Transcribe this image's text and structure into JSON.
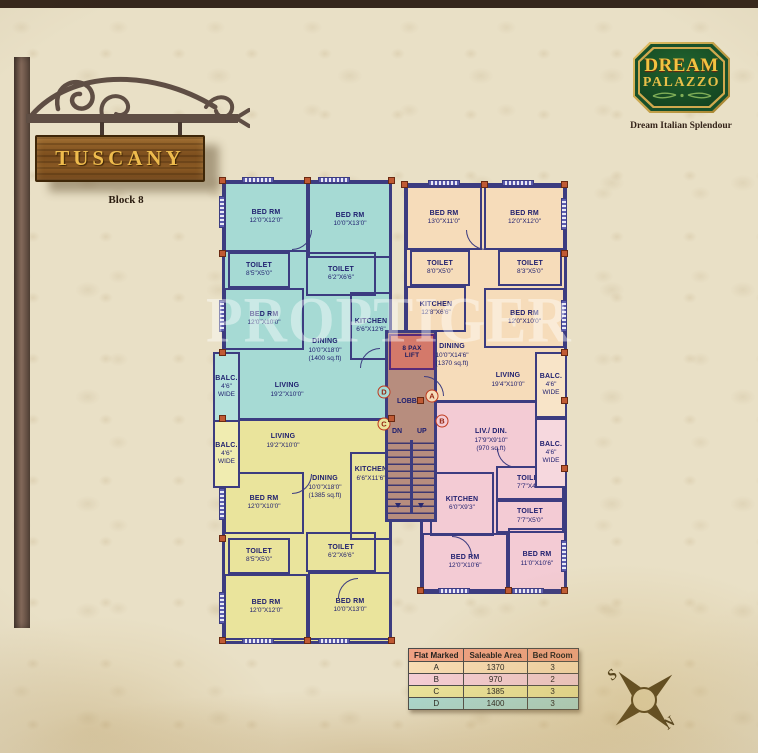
{
  "sign": {
    "title": "TUSCANY",
    "block_label": "Block 8"
  },
  "logo": {
    "name_line1": "DREAM",
    "name_line2": "PALAZZO",
    "tagline": "Dream Italian Splendour"
  },
  "watermark": "PROPTIGER",
  "compass": {
    "south": "S",
    "north": "N"
  },
  "core": {
    "lift_line1": "8 PAX",
    "lift_line2": "LIFT",
    "lobby": "LOBBY",
    "down": "DN",
    "up": "UP"
  },
  "flats": {
    "d": {
      "marker": "D",
      "color": "#a6dad4",
      "rooms": [
        {
          "name": "BED RM",
          "dims": "12'0\"X12'0\""
        },
        {
          "name": "BED RM",
          "dims": "10'0\"X13'0\""
        },
        {
          "name": "TOILET",
          "dims": "8'5\"X5'0\""
        },
        {
          "name": "TOILET",
          "dims": "6'2\"X6'6\""
        },
        {
          "name": "BED RM",
          "dims": "12'0\"X10'0\""
        },
        {
          "name": "KITCHEN",
          "dims": "6'6\"X12'6\""
        },
        {
          "name": "DINING",
          "dims": "10'0\"X18'0\"",
          "note": "(1400 sq.ft)"
        },
        {
          "name": "LIVING",
          "dims": "19'2\"X10'0\""
        },
        {
          "name": "BALC.",
          "dims": "4'6\"",
          "note": "WIDE"
        }
      ]
    },
    "a": {
      "marker": "A",
      "color": "#f6dcba",
      "rooms": [
        {
          "name": "BED RM",
          "dims": "13'0\"X11'0\""
        },
        {
          "name": "BED RM",
          "dims": "12'0\"X12'0\""
        },
        {
          "name": "TOILET",
          "dims": "8'0\"X5'0\""
        },
        {
          "name": "TOILET",
          "dims": "8'3\"X5'0\""
        },
        {
          "name": "KITCHEN",
          "dims": "12'8\"X6'6\""
        },
        {
          "name": "BED RM",
          "dims": "12'0\"X10'0\""
        },
        {
          "name": "DINING",
          "dims": "10'0\"X14'6\"",
          "note": "(1370 sq.ft)"
        },
        {
          "name": "LIVING",
          "dims": "19'4\"X10'0\""
        },
        {
          "name": "BALC.",
          "dims": "4'6\"",
          "note": "WIDE"
        }
      ]
    },
    "c": {
      "marker": "C",
      "color": "#eae49c",
      "rooms": [
        {
          "name": "LIVING",
          "dims": "19'2\"X10'0\""
        },
        {
          "name": "DINING",
          "dims": "10'0\"X18'0\"",
          "note": "(1385 sq.ft)"
        },
        {
          "name": "KITCHEN",
          "dims": "6'6\"X11'6\""
        },
        {
          "name": "BED RM",
          "dims": "12'0\"X10'0\""
        },
        {
          "name": "TOILET",
          "dims": "8'5\"X5'0\""
        },
        {
          "name": "TOILET",
          "dims": "6'2\"X6'6\""
        },
        {
          "name": "BED RM",
          "dims": "12'0\"X12'0\""
        },
        {
          "name": "BED RM",
          "dims": "10'0\"X13'0\""
        },
        {
          "name": "BALC.",
          "dims": "4'6\"",
          "note": "WIDE"
        }
      ]
    },
    "b": {
      "marker": "B",
      "color": "#f3cbd4",
      "rooms": [
        {
          "name": "LIV./ DIN.",
          "dims": "17'9\"X9'10\"",
          "note": "(970 sq.ft)"
        },
        {
          "name": "KITCHEN",
          "dims": "6'0\"X9'3\""
        },
        {
          "name": "TOILET",
          "dims": "7'7\"X4'0\""
        },
        {
          "name": "TOILET",
          "dims": "7'7\"X5'0\""
        },
        {
          "name": "BED RM",
          "dims": "12'0\"X10'6\""
        },
        {
          "name": "BED RM",
          "dims": "11'0\"X10'6\""
        },
        {
          "name": "BALC.",
          "dims": "4'6\"",
          "note": "WIDE"
        }
      ]
    }
  },
  "table": {
    "headers": [
      "Flat Marked",
      "Saleable Area",
      "Bed Room"
    ],
    "rows": [
      {
        "flat": "A",
        "area": "1370",
        "beds": "3"
      },
      {
        "flat": "B",
        "area": "970",
        "beds": "2"
      },
      {
        "flat": "C",
        "area": "1385",
        "beds": "3"
      },
      {
        "flat": "D",
        "area": "1400",
        "beds": "3"
      }
    ]
  }
}
